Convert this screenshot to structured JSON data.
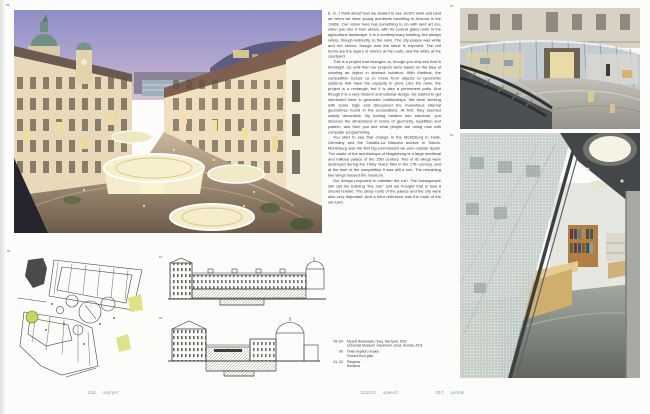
{
  "meta": {
    "accent_color": "#7fa8c9",
    "page_background": "#fcfcfb"
  },
  "folios": {
    "left": {
      "number": "216",
      "label": "портрет"
    },
    "center": {
      "issue": "11/2013",
      "magazine": "speech:"
    },
    "right": {
      "number": "217",
      "label": "portrait"
    }
  },
  "figure_numbers": {
    "courtyard_photo": "59",
    "site_plan": "60",
    "section_a": "61",
    "section_b": "62",
    "entrance_photo": "63",
    "interior_photo": "64"
  },
  "article": {
    "paragraphs": [
      "E. S.: I think about how we started to see Judd's work and land art when we were young architects travelling in Arizona in the 1980s. Our vision here has something to do with land art too, when you see it from above, with its conical glass roofs in the agricultural landscape. It is a contemporary building, but always refers, though indirectly, to the ruins. The city palace was white and red stucco, though now the stone is exposed. The red forms are the layers of domes at the roofs, and the white at the courtyard.",
      "This is a project that changed us, though you only see that in hindsight. Up until then our projects were based on the idea of creating an object in abstract isolation. With Madinat, the competition forced us to move from objects to geometric systems that have the capacity to grow. Like the ruins, the project is a rectangle, but it is also a permanent patio. And though it is a very modern and rational design, we started to get interested there in geometric relationships. We were working with some logic and discovered the marvellous internal geometries found in the excavations. At first, they seemed simply decorative. By turning rotation into structure, you discover the dimensions in terms of geometry, repetition and pattern, and then you see what people are doing now with computer programming.",
      "You start to see that change in the Moritzburg in Halle, Germany and the Castilla-La Mancha archive in Toledo. Moritzburg was the first big commission we won outside Spain. The castle of the archbishops of Magdeburg is a large medieval and military palace of the 15th century. Two of its wings were destroyed during the Thirty Years' War in the 17th century, and at the time of the competition it was still a ruin. The remaining two wings housed the museum.",
      "Our design proposed to maintain the ruin. The townspeople still call the building “the ruin” and we thought that is how it should remain. The steep roofs of the palace and the city were also very important. And a third reference was the roofs of the old town."
    ]
  },
  "captions": {
    "items": [
      {
        "figs": "59–64",
        "ru": "Музей Иоаннеум, Грац, Австрия, 2011",
        "en": "Universal Museum Joanneum, Graz, Austria, 2011"
      },
      {
        "figs": "60",
        "ru": "План первого этажа",
        "en": "Ground floor plan"
      },
      {
        "figs": "61, 62",
        "ru": "Разрезы",
        "en": "Sections"
      }
    ]
  }
}
